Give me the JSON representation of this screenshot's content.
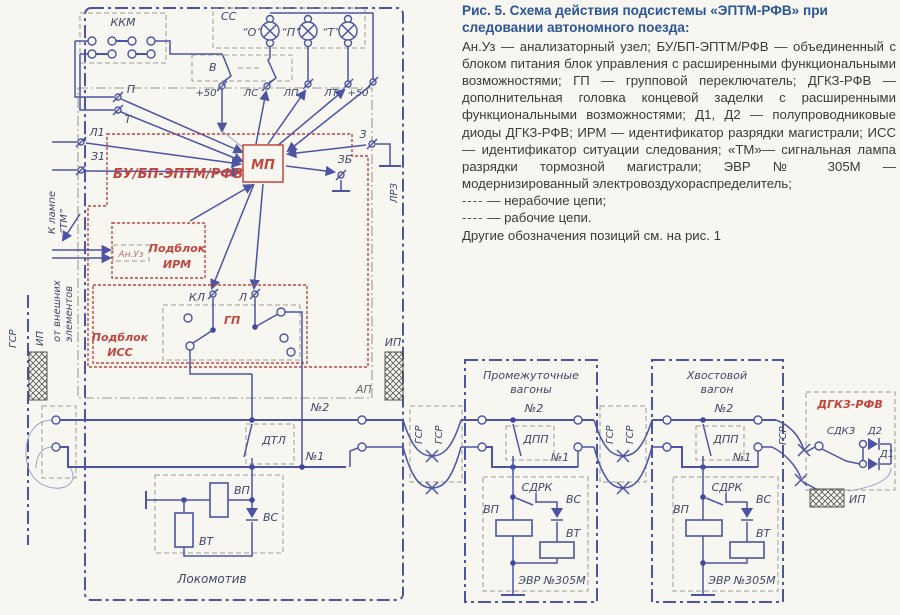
{
  "figure": {
    "title": "Рис. 5. Схема действия подсистемы «ЭПТМ-РФВ» при следовании автономного поезда:",
    "body": "Ан.Уз — анализаторный узел; БУ/БП-ЭПТМ/РФВ — объединенный с блоком питания блок управления с расширенными функциональными возможностями; ГП — групповой переключатель; ДГКЗ-РФВ — дополнительная головка концевой заделки с расширенными функциональными возможностями; Д1, Д2 — полупроводниковые диоды ДГКЗ-РФВ; ИРМ — идентификатор разрядки магистрали; ИСС — идентификатор ситуации следования; «ТМ»— сигнальная лампа разрядки тормозной магистрали; ЭВР № 305М — модернизированный электровоздухораспределитель;",
    "legend": [
      {
        "sample": "----",
        "text": "— нерабочие цепи;"
      },
      {
        "sample": "----",
        "text": "— рабочие цепи."
      }
    ],
    "footnote": "Другие обозначения позиций см. на рис. 1"
  },
  "colors": {
    "wire_blue": "#4b55a4",
    "box_red": "#c4453d",
    "heading_blue": "#2b5597"
  },
  "diagram": {
    "labels": {
      "kkm": "ККМ",
      "ss": "СС",
      "lamp_o": "“О”",
      "lamp_p": "“П”",
      "lamp_t": "“Т”",
      "v": "В",
      "plus50": "+50",
      "ls": "ЛС",
      "lp": "ЛП",
      "lt": "ЛТ",
      "p": "П",
      "t": "Т",
      "l1": "Л1",
      "z1": "З1",
      "k_lampe": "К лампе",
      "tm": "“ТМ”",
      "bu": "БУ/БП-ЭПТМ/РФВ",
      "mp": "МП",
      "z": "З",
      "zb": "ЗБ",
      "lrz": "ЛРЗ",
      "anuz": "Ан.Уз",
      "podblok": "Подблок",
      "irm": "ИРМ",
      "iss": "ИСС",
      "kl": "КЛ",
      "l": "Л",
      "gp": "ГП",
      "gsr": "ГСР",
      "ip": "ИП",
      "ot1": "от внешних",
      "ot2": "элементов",
      "ap": "АП",
      "n2": "№2",
      "n1": "№1",
      "dtl": "ДТЛ",
      "vp": "ВП",
      "vs": "ВС",
      "vt": "ВТ",
      "lokomotiv": "Локомотив",
      "prom1": "Промежуточные",
      "prom2": "вагоны",
      "hvost1": "Хвостовой",
      "hvost2": "вагон",
      "dpp": "ДПП",
      "sdrk": "СДРК",
      "evr": "ЭВР №305М",
      "dgkz": "ДГКЗ-РФВ",
      "sdkz": "СДКЗ",
      "d1": "Д1",
      "d2": "Д2"
    }
  }
}
